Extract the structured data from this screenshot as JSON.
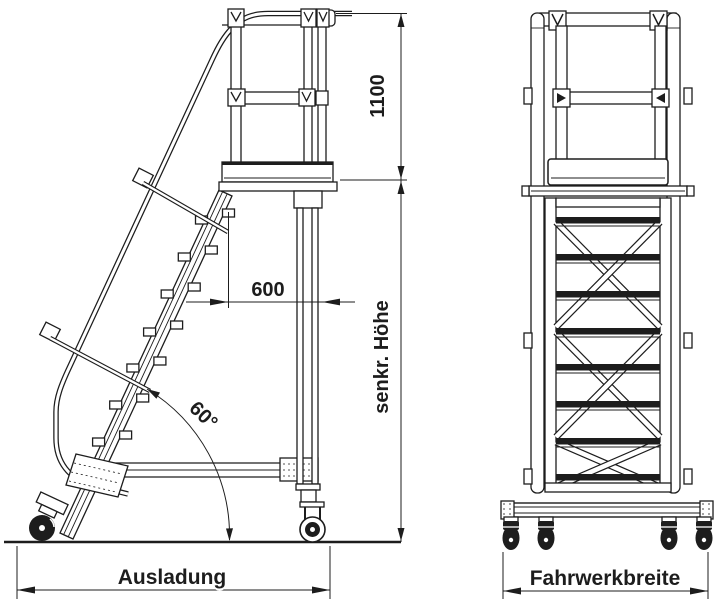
{
  "page": {
    "background": "#ffffff"
  },
  "drawing": {
    "line_color": "#1d1d1d",
    "labels": {
      "guardrail_height": "1100",
      "platform_depth": "600",
      "incline_angle": "60°",
      "vertical_height": "senkr. Höhe",
      "outreach": "Ausladung",
      "chassis_width": "Fahrwerkbreite"
    }
  }
}
